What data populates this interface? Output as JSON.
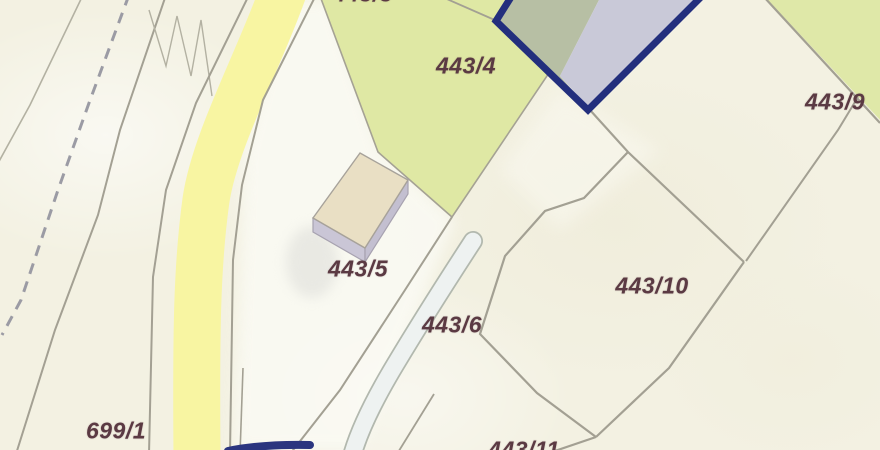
{
  "map": {
    "name": "cadastral-parcel-map",
    "parcel_labels": [
      {
        "id": "443-3",
        "text": "443/3",
        "clipped": "top"
      },
      {
        "id": "443-4",
        "text": "443/4",
        "clipped": "none"
      },
      {
        "id": "443-9",
        "text": "443/9",
        "clipped": "none"
      },
      {
        "id": "443-5",
        "text": "443/5",
        "clipped": "none"
      },
      {
        "id": "443-6",
        "text": "443/6",
        "clipped": "none"
      },
      {
        "id": "443-10",
        "text": "443/10",
        "clipped": "none"
      },
      {
        "id": "699-1",
        "text": "699/1",
        "clipped": "none"
      },
      {
        "id": "443-11",
        "text": "443/11",
        "clipped": "bottom"
      }
    ],
    "highlight": {
      "border_color": "#232f7d",
      "fill_left": "#b7bfa4",
      "fill_right": "#c9c9d8"
    },
    "colors": {
      "background": "#f3f1e2",
      "parcel_green": "#dfe8a4",
      "corner_green": "#dfe8a8",
      "road_yellow": "#f8f5a2",
      "boundary_line": "#a3a093",
      "dashed_line": "#9b9ba4",
      "label_text": "#5b3a43",
      "building_roof": "#e9dfc4",
      "building_side": "#c7c3d3",
      "track_fill": "#eef2f1"
    }
  }
}
